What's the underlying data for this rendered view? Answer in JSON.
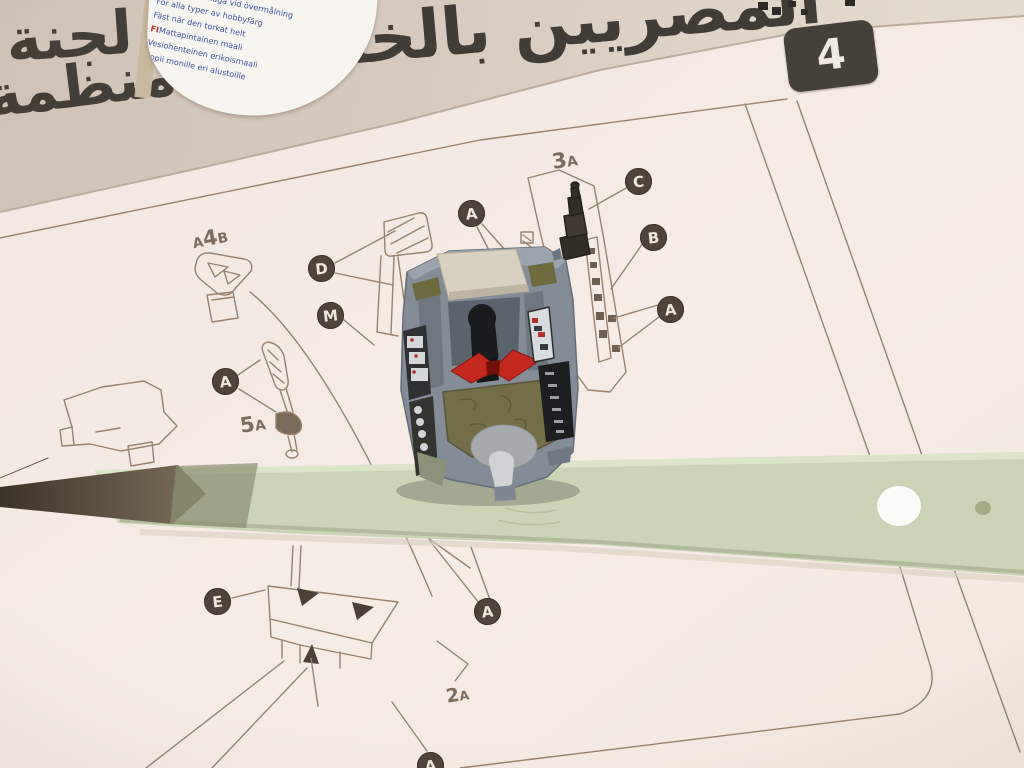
{
  "newspaper": {
    "headline": "المصريين بالخارج",
    "headline_left": "لجنة",
    "headline_bottom": "٥٤٣ منظمة",
    "headline_partial": "ج",
    "caption_small": "نقال على"
  },
  "paint_tin_label": {
    "lines": [
      {
        "code": "SE",
        "text": "Matt"
      },
      {
        "code": "",
        "text": "God täckförmåga vid övermålning"
      },
      {
        "code": "",
        "text": "För alla typer av hobbyfärg"
      },
      {
        "code": "",
        "text": "Fäst när den torkat helt"
      },
      {
        "code": "FI",
        "text": "Mattapintainen maali"
      },
      {
        "code": "",
        "text": "Vesiohenteinen erikoismaali"
      },
      {
        "code": "",
        "text": "Sopii monille eri alustoille"
      }
    ]
  },
  "instruction_sheet": {
    "step_number": "4",
    "part_labels": [
      {
        "pre": "",
        "main": "3",
        "suf": "A"
      },
      {
        "pre": "A",
        "main": "4",
        "suf": "B"
      },
      {
        "pre": "",
        "main": "5",
        "suf": "A"
      },
      {
        "pre": "",
        "main": "2",
        "suf": "A"
      }
    ],
    "callouts": [
      "D",
      "M",
      "A",
      "A",
      "C",
      "B",
      "A",
      "E",
      "A",
      "A"
    ]
  },
  "colors": {
    "sheet": "#f5ebe5",
    "newsprint": "#d5cabf",
    "strip_green": "#cbd5b6",
    "model_grey": "#838c97",
    "yoke_red": "#c3281e",
    "seat_olive": "#736e45",
    "callout_bg": "#4e443b",
    "drawing_line": "#97836f",
    "step_tab": "#46403a"
  }
}
